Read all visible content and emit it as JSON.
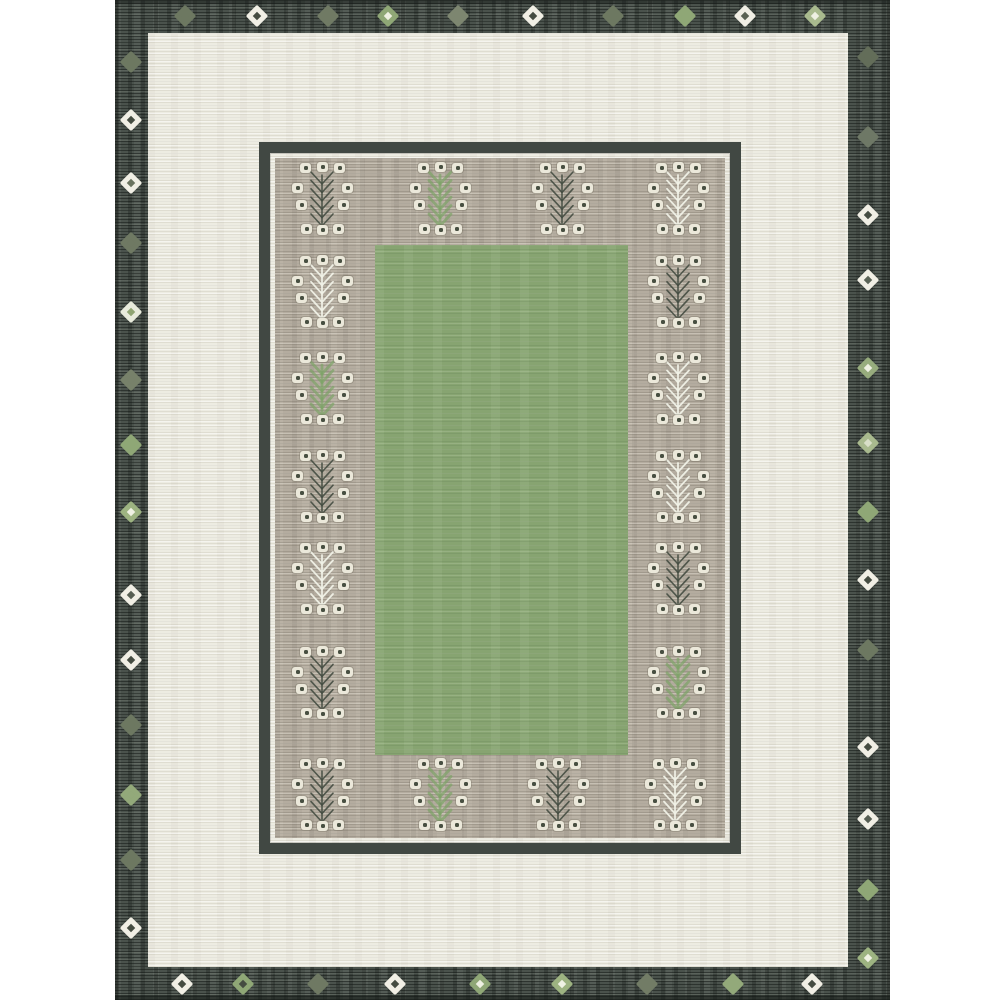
{
  "image": {
    "type": "product-photo",
    "subject": "flatweave area rug with sage green center, greige tree-motif panel, ivory band and charcoal diamond border"
  },
  "canvas": {
    "width": 1000,
    "height": 1000,
    "background": "#ffffff"
  },
  "palette": {
    "page_background": "#ffffff",
    "border_base": "#4a524c",
    "border_dark_streak": "#363d38",
    "border_light_streak": "#6b746b",
    "ivory": "#edece2",
    "greige": "#b4ac9f",
    "green_field": "#87a471",
    "frame_dark": "#414843",
    "square_cream": "#ebe8da",
    "square_dot": "#474f41",
    "stem_dark": "#454d42",
    "stem_white": "#f1f2e7",
    "stem_green": "#7ea468"
  },
  "layout": {
    "rug": {
      "x": 115,
      "y": 0,
      "w": 775,
      "h": 1000
    },
    "ivory_band": {
      "x": 148,
      "y": 33,
      "w": 700,
      "h": 934
    },
    "inner_frame": {
      "x": 259,
      "y": 142,
      "w": 482,
      "h": 712,
      "thickness": 11
    },
    "gray_panel": {
      "x": 275,
      "y": 158,
      "w": 450,
      "h": 680
    },
    "green_field": {
      "x": 375,
      "y": 245,
      "w": 253,
      "h": 510
    }
  },
  "motif_template": {
    "box_w": 60,
    "box_h": 80,
    "squares": [
      [
        -17,
        -34
      ],
      [
        0,
        -35
      ],
      [
        17,
        -34
      ],
      [
        -25,
        -14
      ],
      [
        25,
        -14
      ],
      [
        -21,
        3
      ],
      [
        21,
        3
      ],
      [
        -16,
        27
      ],
      [
        0,
        28
      ],
      [
        16,
        27
      ]
    ]
  },
  "stem_styles": {
    "dark": {
      "color": "#454d42",
      "width": 1.6,
      "opacity": 0.9
    },
    "white": {
      "color": "#f1f2e7",
      "width": 1.8,
      "opacity": 0.95
    },
    "green": {
      "color": "#7ea468",
      "width": 2.8,
      "opacity": 0.7
    }
  },
  "motifs": [
    {
      "x": 322,
      "y": 202,
      "stem": "dark"
    },
    {
      "x": 440,
      "y": 202,
      "stem": "green"
    },
    {
      "x": 562,
      "y": 202,
      "stem": "dark"
    },
    {
      "x": 678,
      "y": 202,
      "stem": "white"
    },
    {
      "x": 322,
      "y": 798,
      "stem": "dark"
    },
    {
      "x": 440,
      "y": 798,
      "stem": "green"
    },
    {
      "x": 558,
      "y": 798,
      "stem": "dark"
    },
    {
      "x": 675,
      "y": 798,
      "stem": "white"
    },
    {
      "x": 322,
      "y": 295,
      "stem": "white"
    },
    {
      "x": 322,
      "y": 392,
      "stem": "green"
    },
    {
      "x": 322,
      "y": 490,
      "stem": "dark"
    },
    {
      "x": 322,
      "y": 582,
      "stem": "white"
    },
    {
      "x": 322,
      "y": 686,
      "stem": "dark"
    },
    {
      "x": 678,
      "y": 295,
      "stem": "dark"
    },
    {
      "x": 678,
      "y": 392,
      "stem": "white"
    },
    {
      "x": 678,
      "y": 490,
      "stem": "white"
    },
    {
      "x": 678,
      "y": 582,
      "stem": "dark"
    },
    {
      "x": 678,
      "y": 686,
      "stem": "green"
    }
  ],
  "diamonds": [
    {
      "x": 185,
      "y": 16,
      "o": "#6d7861",
      "i": "#6d7861"
    },
    {
      "x": 257,
      "y": 16,
      "o": "#f1efe5",
      "i": "#454c41"
    },
    {
      "x": 328,
      "y": 16,
      "o": "#707a64",
      "i": "#707a64"
    },
    {
      "x": 388,
      "y": 16,
      "o": "#8fa776",
      "i": "#eef0e2"
    },
    {
      "x": 458,
      "y": 16,
      "o": "#7d8670",
      "i": "#7d8670"
    },
    {
      "x": 533,
      "y": 16,
      "o": "#f1efe5",
      "i": "#454c41"
    },
    {
      "x": 613,
      "y": 16,
      "o": "#6d7861",
      "i": "#6d7861"
    },
    {
      "x": 685,
      "y": 16,
      "o": "#8fa776",
      "i": "#8fa776"
    },
    {
      "x": 745,
      "y": 16,
      "o": "#f1efe5",
      "i": "#5a6253"
    },
    {
      "x": 815,
      "y": 16,
      "o": "#a9ba8e",
      "i": "#eef0e2"
    },
    {
      "x": 131,
      "y": 62,
      "o": "#6d7861",
      "i": "#6d7861"
    },
    {
      "x": 131,
      "y": 120,
      "o": "#f1efe5",
      "i": "#454c41"
    },
    {
      "x": 131,
      "y": 183,
      "o": "#f1efe5",
      "i": "#6a735f"
    },
    {
      "x": 131,
      "y": 243,
      "o": "#6f7963",
      "i": "#6f7963"
    },
    {
      "x": 131,
      "y": 312,
      "o": "#e8ebdc",
      "i": "#8fa472"
    },
    {
      "x": 131,
      "y": 380,
      "o": "#77816a",
      "i": "#77816a"
    },
    {
      "x": 131,
      "y": 445,
      "o": "#8fa776",
      "i": "#8fa776"
    },
    {
      "x": 131,
      "y": 512,
      "o": "#9db381",
      "i": "#f0f2e4"
    },
    {
      "x": 131,
      "y": 595,
      "o": "#f1efe5",
      "i": "#565e52"
    },
    {
      "x": 131,
      "y": 660,
      "o": "#f1efe5",
      "i": "#454c41"
    },
    {
      "x": 131,
      "y": 725,
      "o": "#6d7861",
      "i": "#6d7861"
    },
    {
      "x": 131,
      "y": 795,
      "o": "#93a97a",
      "i": "#93a97a"
    },
    {
      "x": 131,
      "y": 860,
      "o": "#6d7861",
      "i": "#6d7861"
    },
    {
      "x": 131,
      "y": 928,
      "o": "#f1efe5",
      "i": "#454c41"
    },
    {
      "x": 868,
      "y": 57,
      "o": "#636d59",
      "i": "#636d59"
    },
    {
      "x": 868,
      "y": 137,
      "o": "#6e7866",
      "i": "#6e7866"
    },
    {
      "x": 868,
      "y": 215,
      "o": "#f1efe5",
      "i": "#454c41"
    },
    {
      "x": 868,
      "y": 280,
      "o": "#f1efe5",
      "i": "#5a6356"
    },
    {
      "x": 868,
      "y": 368,
      "o": "#97ac7d",
      "i": "#eef0e2"
    },
    {
      "x": 868,
      "y": 443,
      "o": "#a9ba8e",
      "i": "#d9dfc8"
    },
    {
      "x": 868,
      "y": 512,
      "o": "#8fa776",
      "i": "#8fa776"
    },
    {
      "x": 868,
      "y": 580,
      "o": "#f1efe5",
      "i": "#454c41"
    },
    {
      "x": 868,
      "y": 650,
      "o": "#6d7861",
      "i": "#6d7861"
    },
    {
      "x": 868,
      "y": 747,
      "o": "#f1efe5",
      "i": "#454c41"
    },
    {
      "x": 868,
      "y": 819,
      "o": "#f1efe5",
      "i": "#565e52"
    },
    {
      "x": 868,
      "y": 890,
      "o": "#8fa776",
      "i": "#8fa776"
    },
    {
      "x": 868,
      "y": 958,
      "o": "#9db381",
      "i": "#f0f2e4"
    },
    {
      "x": 182,
      "y": 984,
      "o": "#f1efe5",
      "i": "#454c41"
    },
    {
      "x": 243,
      "y": 984,
      "o": "#8fa776",
      "i": "#454c41"
    },
    {
      "x": 318,
      "y": 984,
      "o": "#6f7963",
      "i": "#6f7963"
    },
    {
      "x": 395,
      "y": 984,
      "o": "#f1efe5",
      "i": "#454c41"
    },
    {
      "x": 480,
      "y": 984,
      "o": "#8fa776",
      "i": "#eef0e2"
    },
    {
      "x": 562,
      "y": 984,
      "o": "#9db381",
      "i": "#f0f2e4"
    },
    {
      "x": 647,
      "y": 984,
      "o": "#727c66",
      "i": "#727c66"
    },
    {
      "x": 733,
      "y": 984,
      "o": "#93a97a",
      "i": "#93a97a"
    },
    {
      "x": 812,
      "y": 984,
      "o": "#f1efe5",
      "i": "#454c41"
    }
  ]
}
